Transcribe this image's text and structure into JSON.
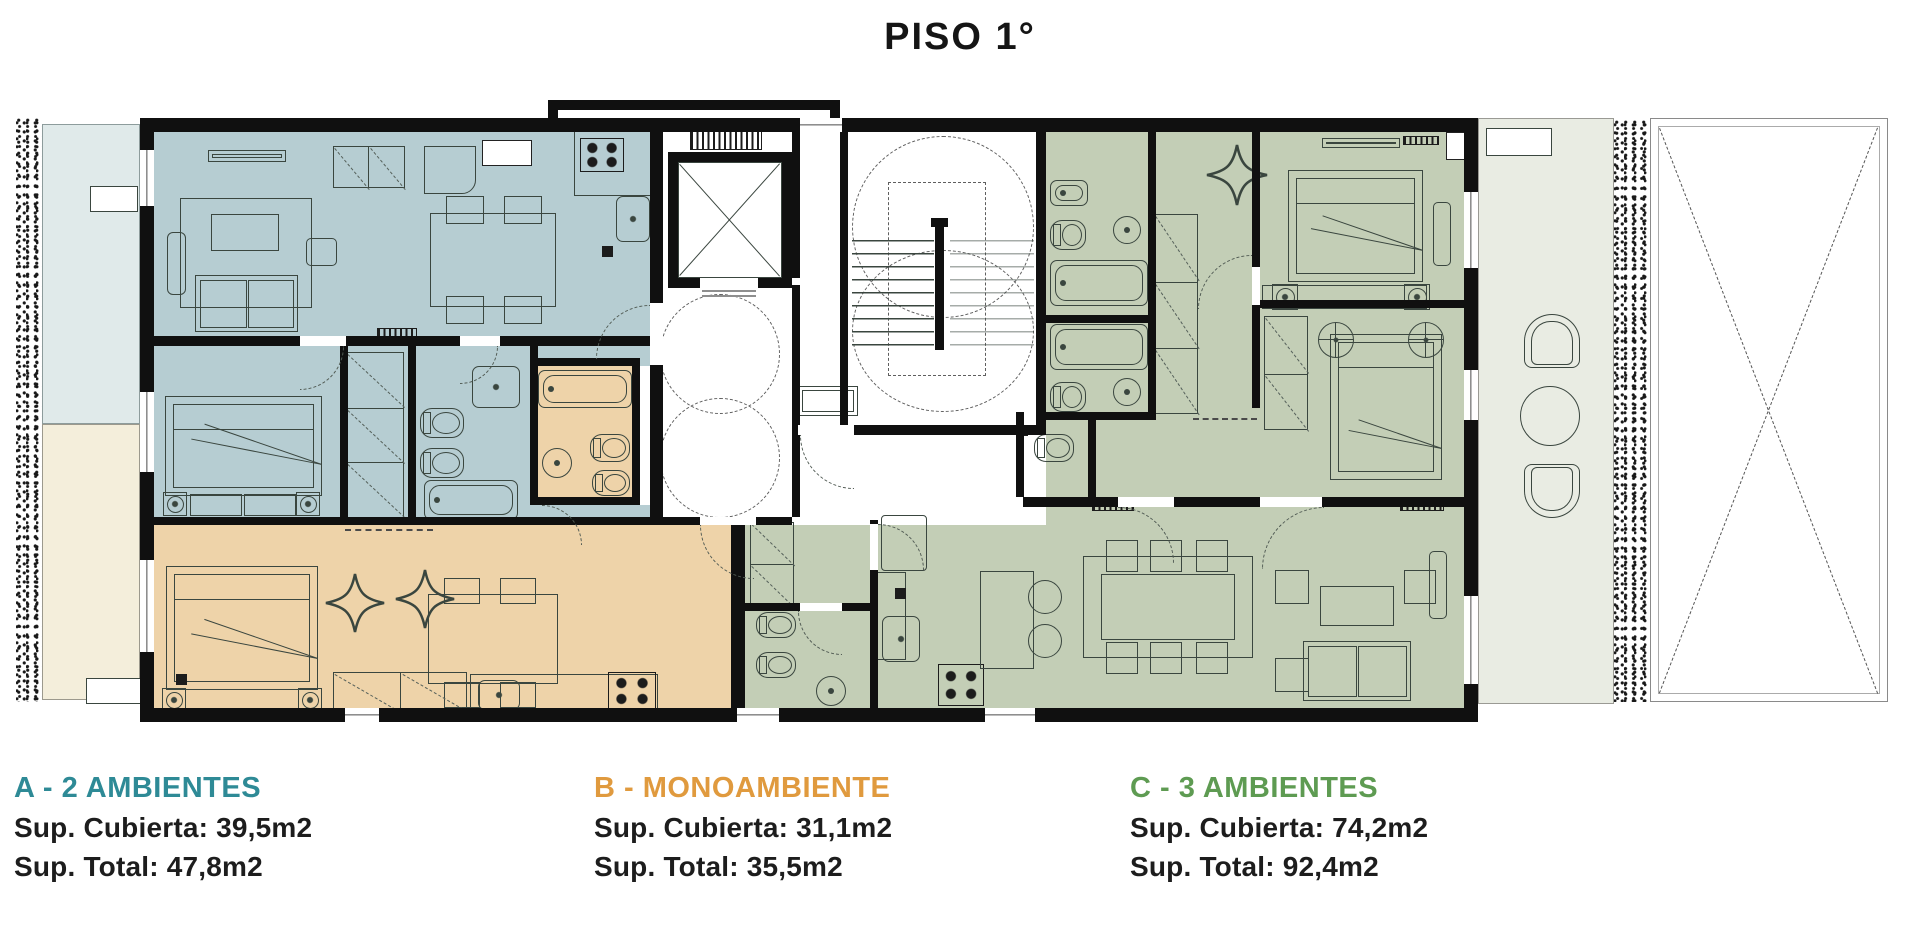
{
  "title": "PISO 1°",
  "legend": {
    "items": [
      {
        "id": "A",
        "label": "A - 2 AMBIENTES",
        "color": "#2e8a96",
        "line1": "Sup. Cubierta: 39,5m2",
        "line2": "Sup. Total: 47,8m2"
      },
      {
        "id": "B",
        "label": "B - MONOAMBIENTE",
        "color": "#e09a3e",
        "line1": "Sup. Cubierta: 31,1m2",
        "line2": "Sup. Total: 35,5m2"
      },
      {
        "id": "C",
        "label": "C - 3 AMBIENTES",
        "color": "#5e9b52",
        "line1": "Sup. Cubierta: 74,2m2",
        "line2": "Sup. Total: 92,4m2"
      }
    ]
  },
  "plan": {
    "floor": "PISO 1°",
    "units": [
      {
        "id": "A",
        "type": "2 ambientes",
        "fill": "#b6cdd2"
      },
      {
        "id": "B",
        "type": "monoambiente",
        "fill": "#eed3a9"
      },
      {
        "id": "C",
        "type": "3 ambientes",
        "fill": "#c3ceb6"
      }
    ],
    "colors": {
      "unit_a_fill": "#b6cdd2",
      "unit_b_fill": "#eed3a9",
      "unit_c_fill": "#c3ceb6",
      "balcony_a_fill": "#e0eaea",
      "balcony_b_fill": "#f4eedb",
      "terrace_fill": "#e9ece3",
      "wall": "#101010",
      "line": "#3a463f"
    }
  }
}
